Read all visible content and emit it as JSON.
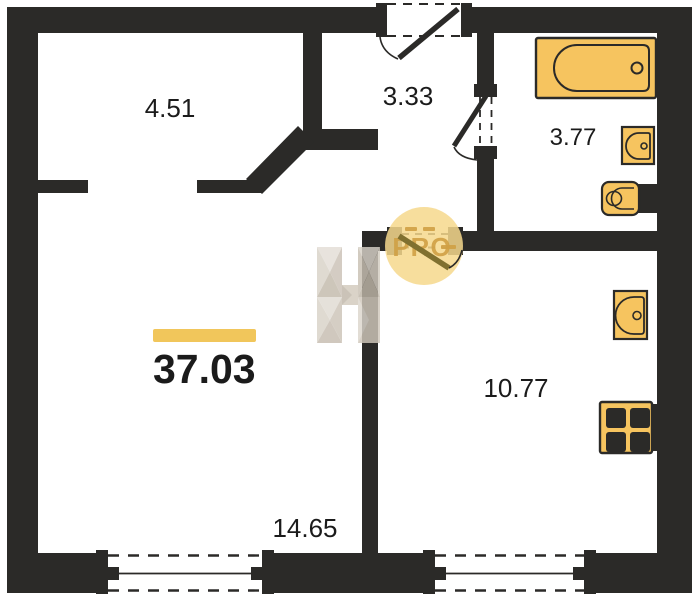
{
  "plan": {
    "total_area": {
      "value": "37.03"
    },
    "rooms": [
      {
        "name": "hallway",
        "area": "4.51"
      },
      {
        "name": "entrance-hall",
        "area": "3.33"
      },
      {
        "name": "bathroom",
        "area": "3.77",
        "fixtures": [
          "bathtub",
          "sink",
          "toilet"
        ]
      },
      {
        "name": "living-room",
        "area": "14.65"
      },
      {
        "name": "kitchen",
        "area": "10.77",
        "fixtures": [
          "sink",
          "stove"
        ]
      }
    ],
    "watermark": {
      "badge_text": "PRO",
      "logo": "H-logo"
    },
    "colors": {
      "background": "#ffffff",
      "wall": "#2b2a28",
      "fixture_fill": "#f6c45f",
      "fixture_stroke": "#2b2a28",
      "accent_bar": "#f1c65b",
      "door_leaf": "#80702f",
      "pro_circle_fill": "#f6d88c",
      "pro_text": "#cfa045",
      "label_text": "#1b1b1b",
      "watermark_light": "#e3ded6",
      "watermark_mid": "#d2cabd",
      "watermark_dark": "#c3baac"
    }
  }
}
